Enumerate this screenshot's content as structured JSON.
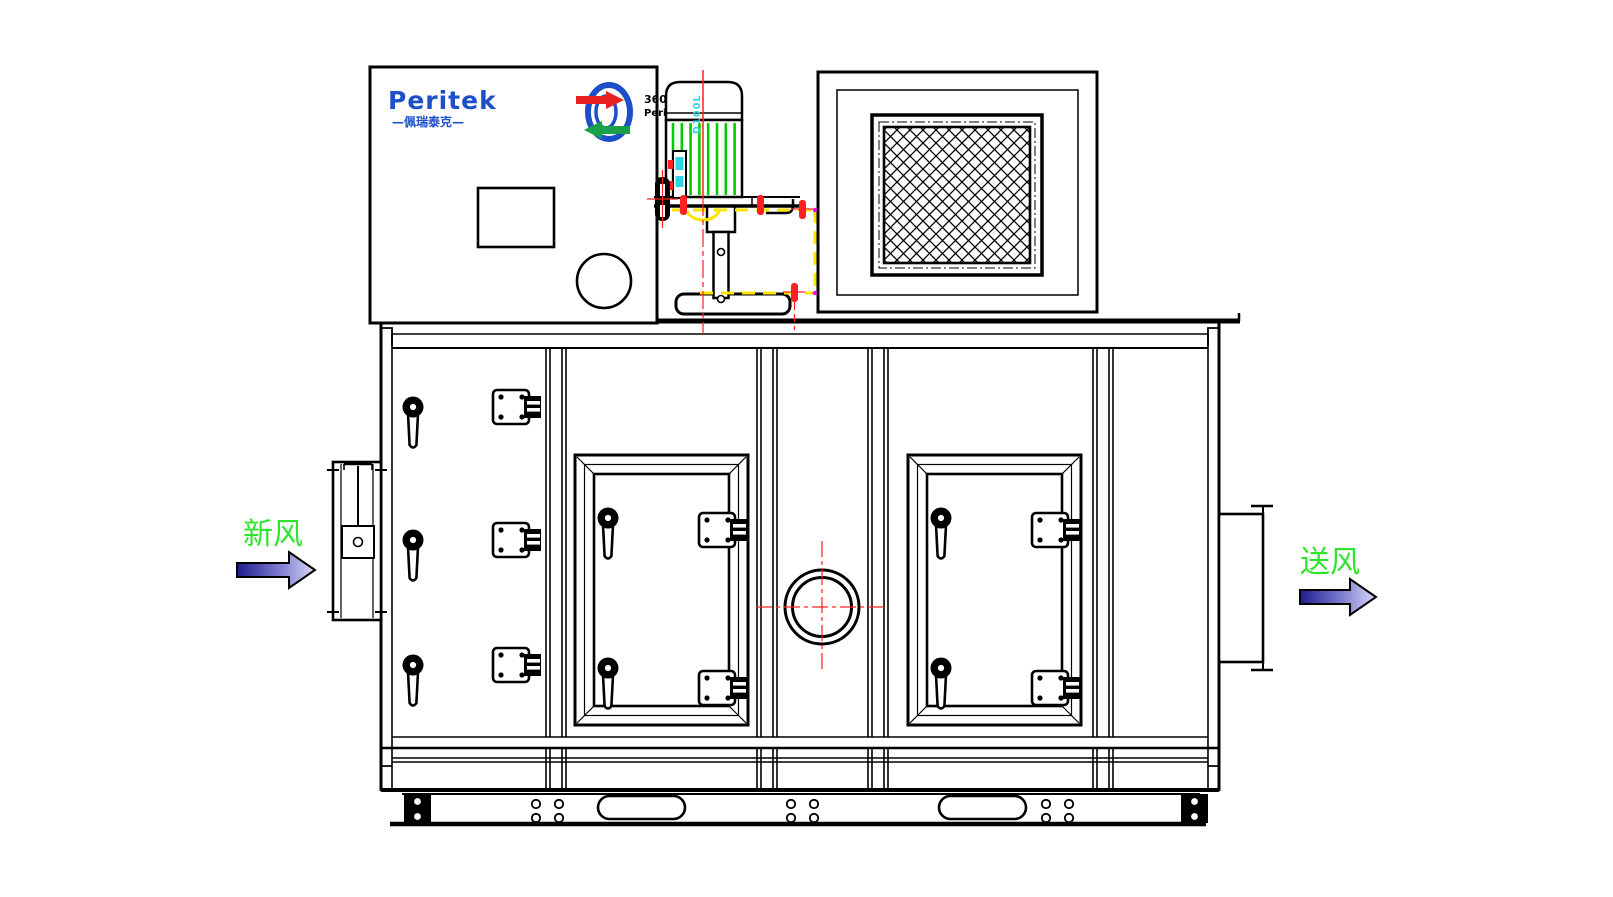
{
  "labels": {
    "fresh_air": "新风",
    "supply_air": "送风"
  },
  "branding": {
    "name": "Peritek",
    "name_cn": "—佩瑞泰克—",
    "rotor_badge_line1": "360°",
    "rotor_badge_line2": "Peritek"
  },
  "motor": {
    "model": "D100L"
  },
  "icons": {
    "fresh_air_arrow": "flow-arrow-right",
    "supply_air_arrow": "flow-arrow-right",
    "rotor_logo": "rotary-wheel-with-arrows"
  },
  "colors": {
    "line_black": "#000000",
    "centerline_red": "#ff2020",
    "phantom_yellow": "#ffe400",
    "motor_fin_green": "#00cc00",
    "cyan_accent": "#2fd5e0",
    "brand_blue": "#1d50c8",
    "label_green": "#2ee52e",
    "magenta_marker": "#ff00ff",
    "arrow_fill_dark": "#1c1c8f",
    "arrow_fill_mid": "#7d7dd0",
    "arrow_fill_light": "#d8d8f8"
  }
}
